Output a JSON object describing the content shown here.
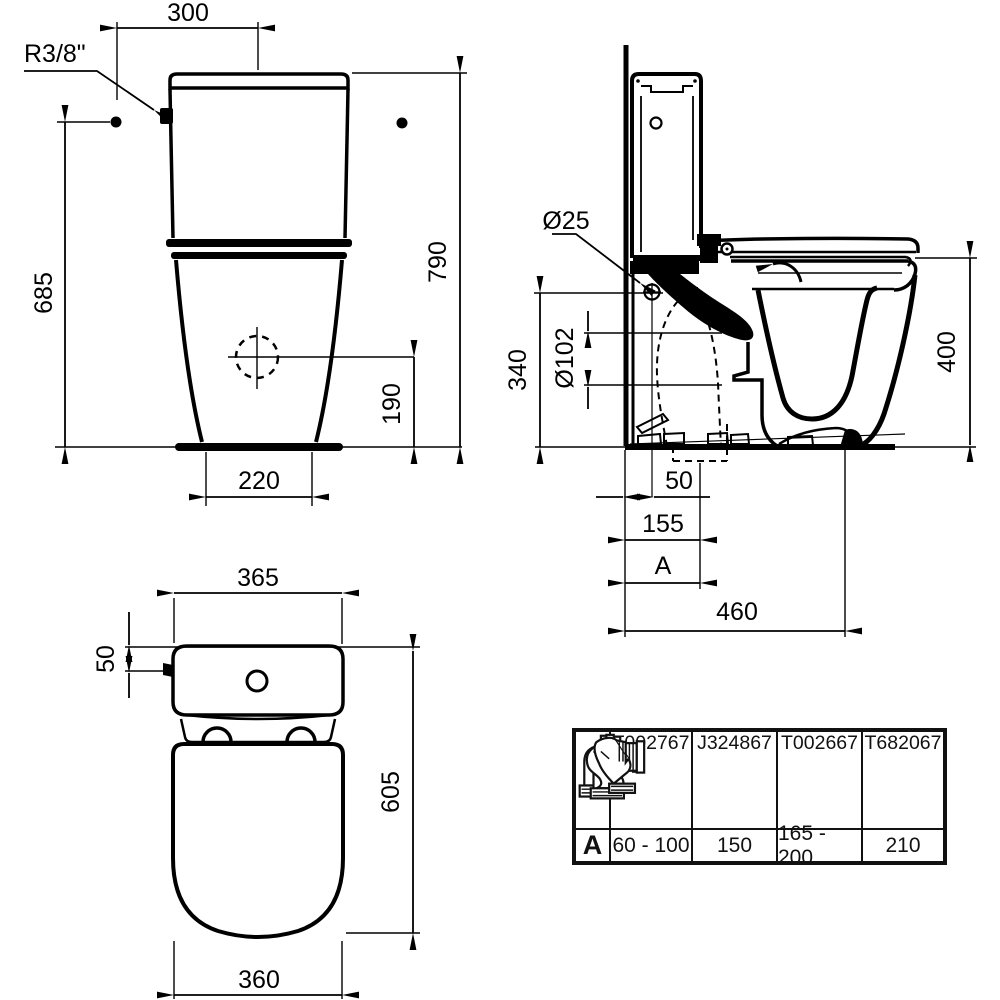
{
  "front_view": {
    "dim_supply_offset": "300",
    "inlet_thread": "R3/8\"",
    "dim_inlet_height": "685",
    "dim_total_height": "790",
    "dim_outlet_center_height": "190",
    "dim_base_width": "220"
  },
  "side_view": {
    "inlet_diameter": "Ø25",
    "outlet_diameter": "Ø102",
    "dim_inlet_height": "340",
    "dim_rim_height": "400",
    "dim_wall_to_inlet": "50",
    "dim_wall_to_outlet": "155",
    "dim_variable": "A",
    "dim_total_depth": "460"
  },
  "top_view": {
    "dim_cistern_width": "365",
    "dim_inlet_offset": "50",
    "dim_total_depth": "605",
    "dim_bowl_width": "360"
  },
  "table": {
    "row_label": "A",
    "columns": [
      {
        "part": "T002767",
        "value": "60 - 100",
        "icon": "elbow-corrugated-connector-icon"
      },
      {
        "part": "J324867",
        "value": "150",
        "icon": "offset-connector-icon"
      },
      {
        "part": "T002667",
        "value": "165 - 200",
        "icon": "s-bend-corrugated-connector-icon"
      },
      {
        "part": "T682067",
        "value": "210",
        "icon": "angled-connector-icon"
      }
    ]
  },
  "colors": {
    "line": "#000000",
    "background": "#ffffff"
  }
}
